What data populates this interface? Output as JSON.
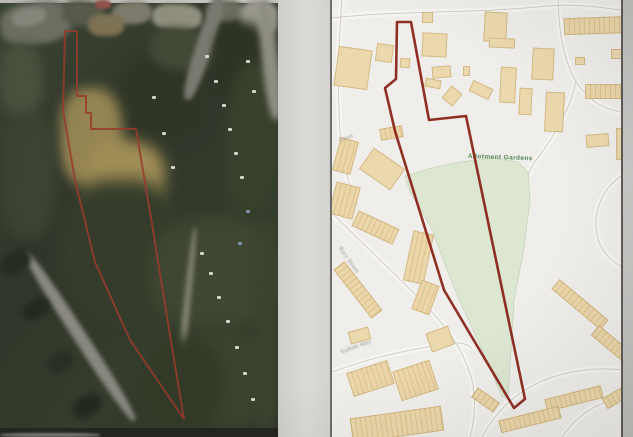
{
  "page": {
    "description": "Scanned property particulars page with aerial photograph (left) and Ordnance-Survey style location plan (right), both marked with red site boundary",
    "bg_color": "#d8d6d2",
    "gap_color": "#dedcd8",
    "edge_strip_color": "#c6c5c3"
  },
  "left_aerial": {
    "boundary_color": "#9e3a28",
    "boundary_points": "65,31 77,31 77,96 86,96 86,113 91,113 91,129 136,129 151,218 170,335 184,419 130,340 95,262 75,180 63,110",
    "patches": [
      [
        0,
        0,
        278,
        3,
        0,
        "#c9c8c3",
        0
      ],
      [
        0,
        2,
        72,
        42,
        -8,
        "#6e7263",
        3
      ],
      [
        12,
        8,
        34,
        18,
        -10,
        "#8c8c80",
        2
      ],
      [
        62,
        0,
        42,
        26,
        5,
        "#585b4a",
        3
      ],
      [
        112,
        2,
        40,
        22,
        -4,
        "#7f7d6e",
        2
      ],
      [
        152,
        4,
        50,
        26,
        3,
        "#91907f",
        2
      ],
      [
        95,
        0,
        16,
        9,
        0,
        "#96544a",
        1
      ],
      [
        206,
        0,
        38,
        22,
        0,
        "#6c6c5e",
        2
      ],
      [
        240,
        0,
        38,
        36,
        4,
        "#9b998d",
        3
      ],
      [
        120,
        55,
        85,
        85,
        0,
        "#2e3523",
        7
      ],
      [
        150,
        28,
        64,
        42,
        8,
        "#414834",
        4
      ],
      [
        196,
        -8,
        16,
        110,
        18,
        "#7b7a6f",
        2
      ],
      [
        215,
        22,
        52,
        75,
        0,
        "#2c3321",
        5
      ],
      [
        228,
        62,
        50,
        150,
        3,
        "#37402a",
        6
      ],
      [
        60,
        88,
        62,
        98,
        0,
        "#97854e",
        6
      ],
      [
        86,
        140,
        78,
        84,
        10,
        "#a18d51",
        7
      ],
      [
        88,
        14,
        36,
        22,
        0,
        "#817452",
        2
      ],
      [
        0,
        44,
        42,
        72,
        0,
        "#4a513d",
        5
      ],
      [
        0,
        114,
        56,
        124,
        0,
        "#3b4331",
        6
      ],
      [
        60,
        180,
        122,
        142,
        0,
        "#333b28",
        8
      ],
      [
        150,
        218,
        128,
        110,
        0,
        "#3d462f",
        7
      ],
      [
        175,
        330,
        100,
        100,
        0,
        "#39422c",
        7
      ],
      [
        -20,
        330,
        200,
        13,
        57,
        "#8c8b81",
        2
      ],
      [
        0,
        252,
        32,
        20,
        -32,
        "#23291d",
        3
      ],
      [
        22,
        300,
        28,
        18,
        -32,
        "#21271c",
        3
      ],
      [
        46,
        352,
        28,
        20,
        -32,
        "#282e21",
        3
      ],
      [
        72,
        396,
        30,
        20,
        -32,
        "#20261b",
        3
      ],
      [
        182,
        228,
        7,
        182,
        6,
        "#7f7e6b",
        2
      ],
      [
        255,
        218,
        23,
        219,
        0,
        "#3a422d",
        5
      ],
      [
        140,
        338,
        82,
        99,
        8,
        "#303924",
        6
      ],
      [
        262,
        0,
        16,
        120,
        -6,
        "#8e8d81",
        3
      ],
      [
        0,
        428,
        278,
        9,
        0,
        "#21231d",
        0
      ],
      [
        0,
        433,
        100,
        4,
        0,
        "#80817a",
        1
      ]
    ],
    "specks_white": [
      [
        205,
        55
      ],
      [
        214,
        80
      ],
      [
        222,
        104
      ],
      [
        228,
        128
      ],
      [
        234,
        152
      ],
      [
        240,
        176
      ],
      [
        200,
        252
      ],
      [
        209,
        272
      ],
      [
        217,
        296
      ],
      [
        226,
        320
      ],
      [
        235,
        346
      ],
      [
        243,
        372
      ],
      [
        251,
        398
      ],
      [
        152,
        96
      ],
      [
        162,
        132
      ],
      [
        171,
        166
      ],
      [
        246,
        60
      ],
      [
        252,
        90
      ]
    ],
    "specks_blue": [
      [
        238,
        242
      ],
      [
        246,
        210
      ]
    ],
    "speck_white_color": "#d6d6cd",
    "speck_blue_color": "#7e96aa"
  },
  "right_map": {
    "bg_color": "#f2f0ec",
    "boundary_color": "#8e2116",
    "boundary_points": "395,22 409,22 427,120 464,116 523,399 512,408 442,290 393,131 383,88 394,79",
    "road_casing_color": "#cfccc5",
    "road_fill_color": "#f8f7f3",
    "roads": [
      "M330,18 C400,10 470,14 545,6 C575,3 610,9 633,12",
      "M556,-2 C557,30 560,55 572,78 C585,102 605,112 633,114",
      "M574,82 C568,108 556,130 538,155 C532,162 528,168 526,176",
      "M340,-2 C337,40 335,90 338,130 C340,160 346,185 356,205",
      "M332,215 C365,248 400,280 428,310 C448,331 462,352 470,380 C474,400 473,420 468,437",
      "M330,372 C368,358 404,350 444,344 C456,342 462,342 470,348",
      "M480,437 C500,400 530,380 570,372 C592,368 614,368 633,372",
      "M560,437 C575,415 595,402 620,398 C625,397 630,397 633,397",
      "M633,168 C610,178 596,196 594,220 C593,242 602,258 622,268 C626,270 630,271 633,271"
    ],
    "green_area": {
      "fill": "#dce8d1",
      "stroke": "#c6d6ba",
      "points": "403,176 430,168 458,162 492,158 516,162 526,172 528,200 522,248 512,300 506,398 500,396 478,345 455,295 428,225 408,192",
      "label": {
        "text": "Allotment Gardens",
        "x": 466,
        "y": 153,
        "rot": 2
      }
    },
    "building_fill": "#efdaab",
    "buildings": [
      [
        334,
        48,
        34,
        40,
        8,
        0
      ],
      [
        374,
        44,
        17,
        18,
        8,
        0
      ],
      [
        398,
        58,
        10,
        10,
        5,
        0
      ],
      [
        420,
        12,
        11,
        11,
        0,
        0
      ],
      [
        420,
        33,
        25,
        24,
        3,
        0
      ],
      [
        430,
        66,
        19,
        12,
        -5,
        0
      ],
      [
        423,
        79,
        16,
        9,
        10,
        0
      ],
      [
        443,
        88,
        14,
        16,
        40,
        0
      ],
      [
        468,
        84,
        22,
        12,
        25,
        0
      ],
      [
        461,
        66,
        7,
        10,
        0,
        0
      ],
      [
        498,
        67,
        16,
        36,
        3,
        0
      ],
      [
        517,
        88,
        13,
        27,
        3,
        0
      ],
      [
        482,
        12,
        23,
        30,
        3,
        0
      ],
      [
        487,
        38,
        26,
        10,
        3,
        0
      ],
      [
        530,
        48,
        22,
        32,
        3,
        0
      ],
      [
        543,
        92,
        19,
        40,
        3,
        0
      ],
      [
        562,
        17,
        68,
        17,
        -2,
        1
      ],
      [
        573,
        57,
        10,
        8,
        0,
        0
      ],
      [
        609,
        49,
        11,
        10,
        0,
        0
      ],
      [
        583,
        84,
        46,
        15,
        0,
        1
      ],
      [
        614,
        128,
        16,
        32,
        0,
        0
      ],
      [
        584,
        134,
        23,
        13,
        -5,
        0
      ],
      [
        334,
        139,
        19,
        34,
        15,
        1
      ],
      [
        361,
        156,
        38,
        26,
        35,
        0
      ],
      [
        330,
        184,
        25,
        33,
        15,
        1
      ],
      [
        378,
        127,
        23,
        12,
        -10,
        1
      ],
      [
        351,
        219,
        45,
        17,
        25,
        1
      ],
      [
        406,
        232,
        21,
        51,
        12,
        1
      ],
      [
        414,
        282,
        19,
        31,
        20,
        1
      ],
      [
        325,
        283,
        62,
        14,
        52,
        1
      ],
      [
        347,
        329,
        21,
        13,
        -15,
        0
      ],
      [
        426,
        329,
        24,
        20,
        -20,
        0
      ],
      [
        347,
        366,
        43,
        25,
        -18,
        1
      ],
      [
        394,
        365,
        39,
        31,
        -18,
        1
      ],
      [
        349,
        412,
        92,
        25,
        -8,
        1
      ],
      [
        546,
        298,
        64,
        13,
        40,
        1
      ],
      [
        588,
        337,
        42,
        13,
        40,
        1
      ],
      [
        543,
        392,
        58,
        13,
        -14,
        1
      ],
      [
        497,
        413,
        62,
        13,
        -14,
        1
      ],
      [
        470,
        394,
        27,
        12,
        35,
        1
      ],
      [
        600,
        388,
        40,
        12,
        -30,
        1
      ]
    ],
    "street_labels": [
      {
        "text": "Court",
        "x": 336,
        "y": 138,
        "rot": -18
      },
      {
        "text": "Bury Street",
        "x": 340,
        "y": 246,
        "rot": 55
      },
      {
        "text": "Suffolk Way",
        "x": 338,
        "y": 350,
        "rot": -20
      }
    ]
  }
}
